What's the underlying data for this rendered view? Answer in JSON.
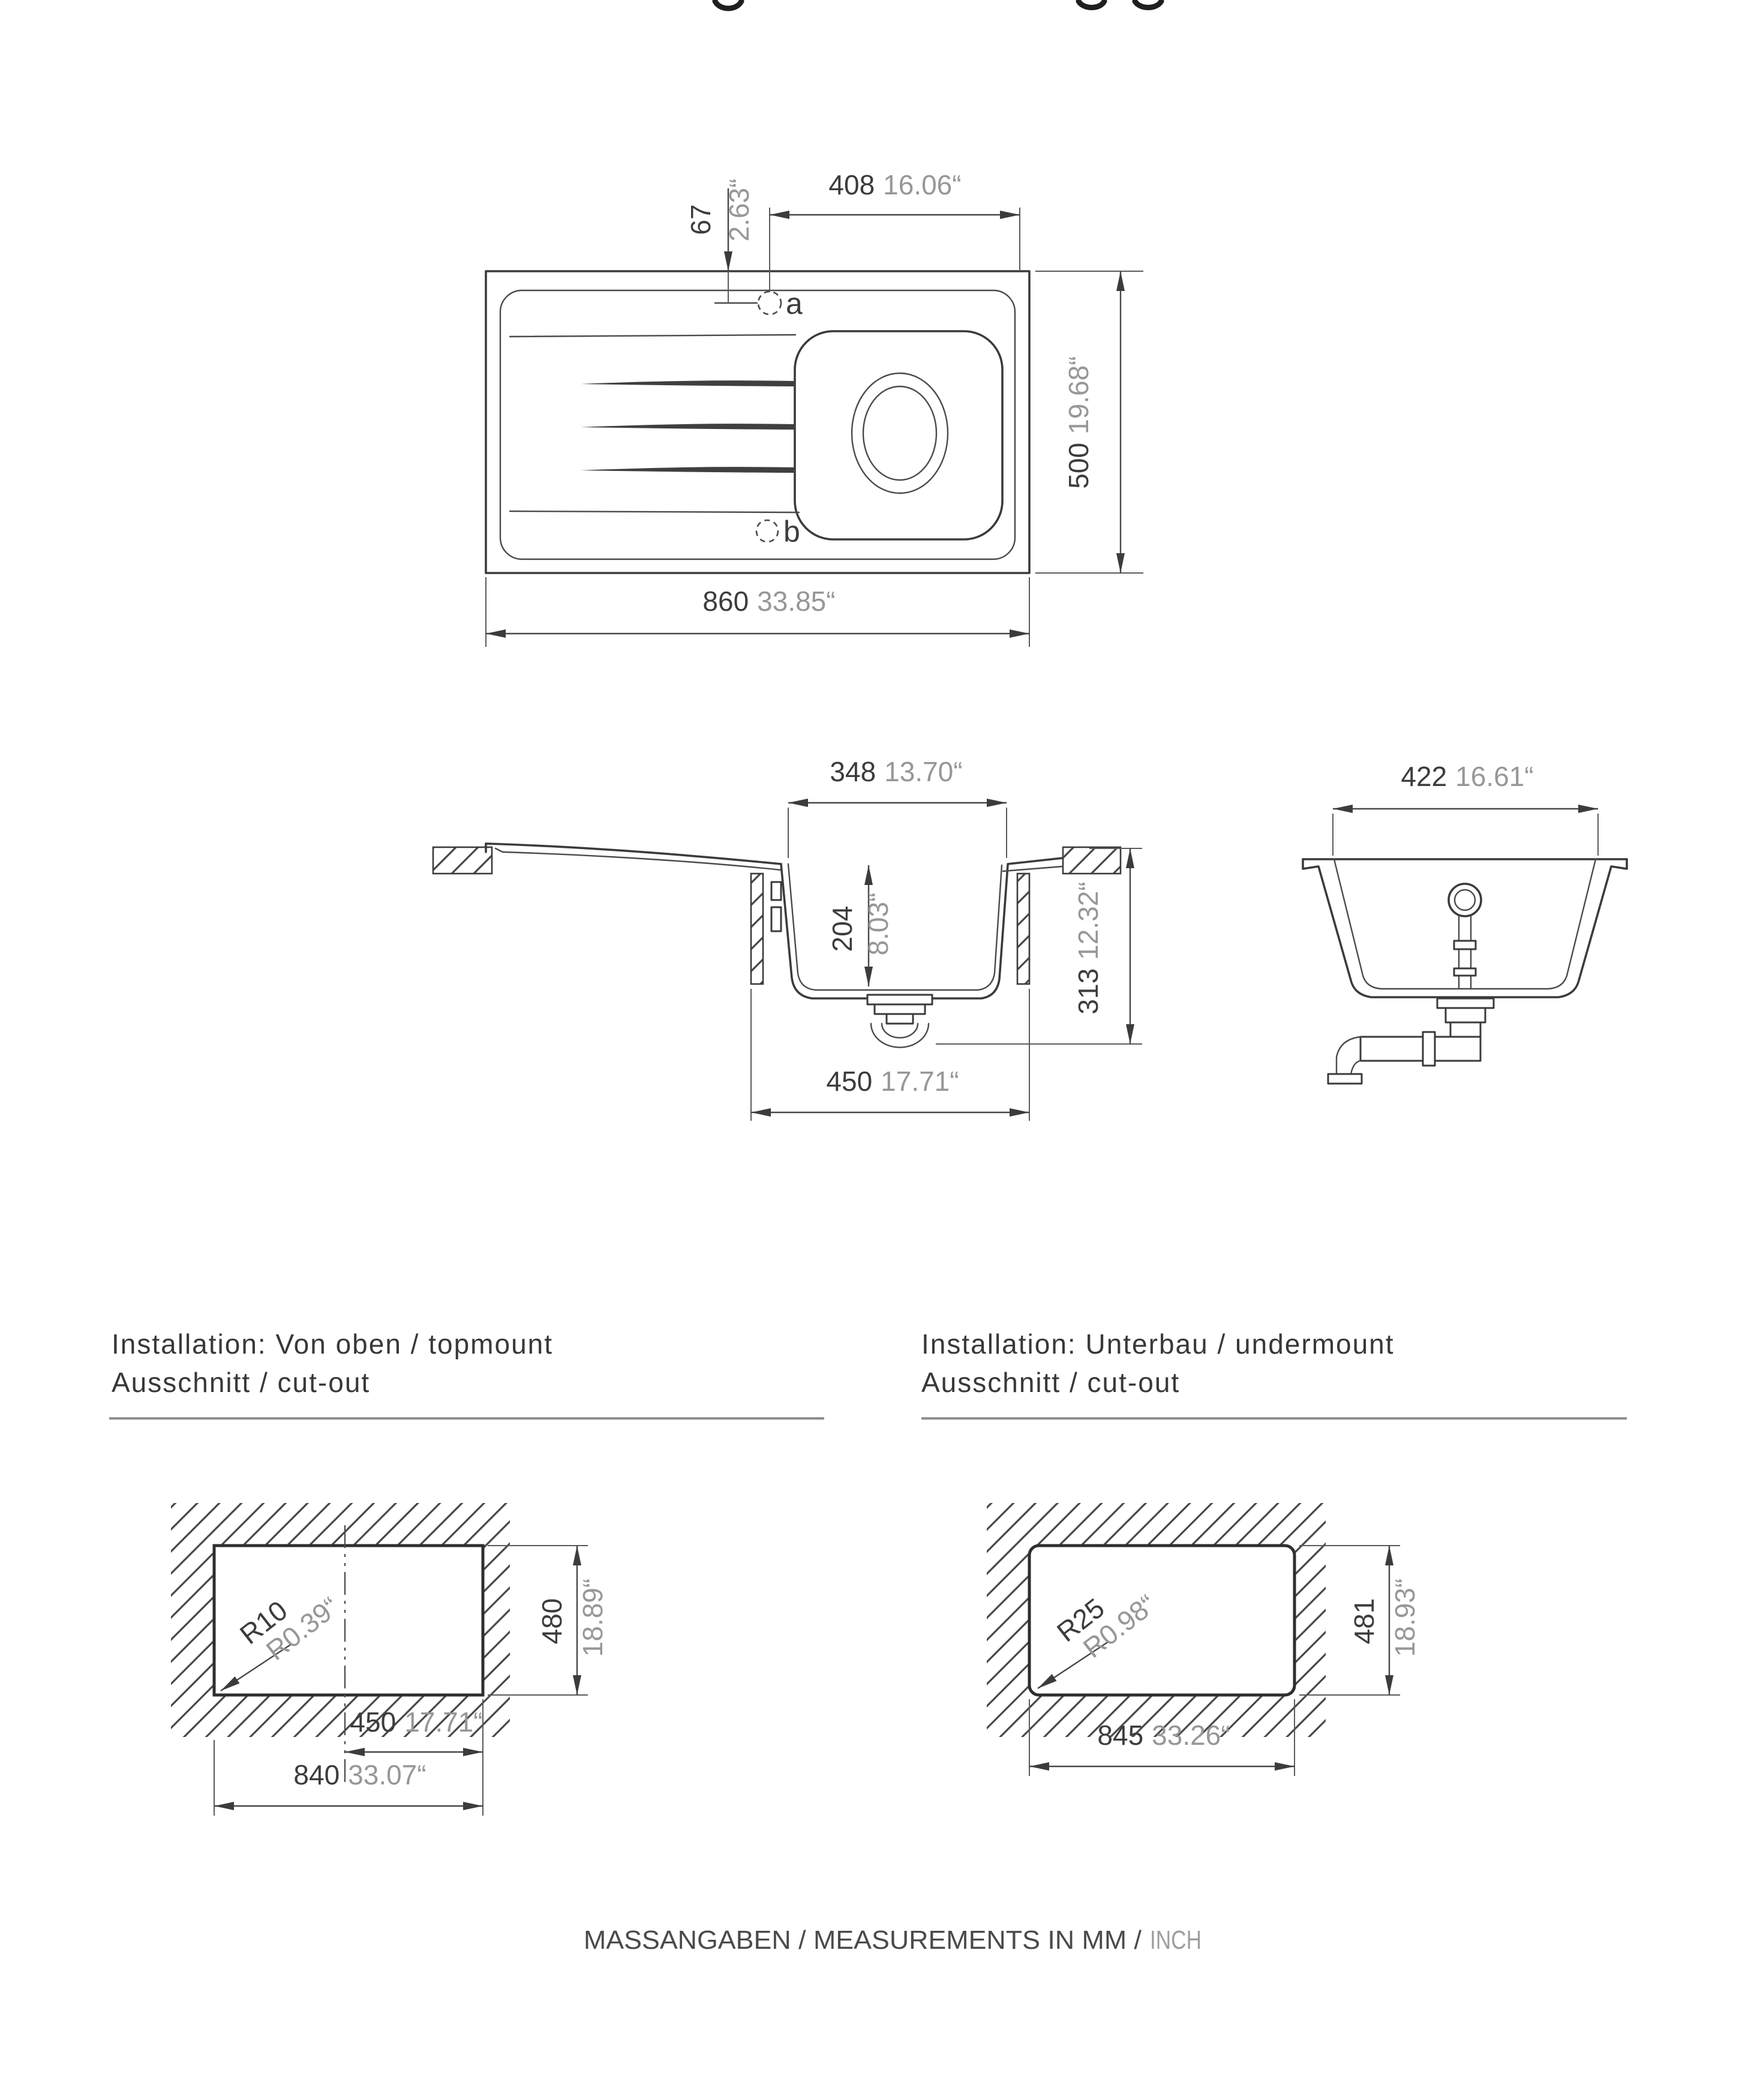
{
  "colors": {
    "background": "#ffffff",
    "drawing_line": "#3b3b3b",
    "dimension_mm_text": "#3c3c3c",
    "dimension_inch_text": "#979797",
    "section_rule": "#8f8f8f",
    "footer_text": "#4a4a4a",
    "footer_inch_text": "#9e9e9e"
  },
  "top_view": {
    "tap_hole_offset_x": {
      "mm": "408",
      "inch": "16.06“"
    },
    "tap_hole_offset_y": {
      "mm": "67",
      "inch": "2.63“"
    },
    "overall_width": {
      "mm": "860",
      "inch": "33.85“"
    },
    "overall_depth": {
      "mm": "500",
      "inch": "19.68“"
    },
    "hole_a_label": "a",
    "hole_b_label": "b"
  },
  "side_section": {
    "bowl_top_width": {
      "mm": "348",
      "inch": "13.70“"
    },
    "bowl_depth": {
      "mm": "204",
      "inch": "8.03“"
    },
    "overall_height": {
      "mm": "313",
      "inch": "12.32“"
    },
    "cabinet_opening": {
      "mm": "450",
      "inch": "17.71“"
    }
  },
  "front_section": {
    "bowl_top_width": {
      "mm": "422",
      "inch": "16.61“"
    }
  },
  "installation_topmount": {
    "line1": "Installation: Von oben / topmount",
    "line2": "Ausschnitt / cut-out"
  },
  "installation_undermount": {
    "line1": "Installation: Unterbau / undermount",
    "line2": "Ausschnitt / cut-out"
  },
  "cutout_topmount": {
    "corner_radius": {
      "mm": "R10",
      "inch": "R0.39“"
    },
    "depth": {
      "mm": "480",
      "inch": "18.89“"
    },
    "center_to_edge": {
      "mm": "450",
      "inch": "17.71“"
    },
    "width": {
      "mm": "840",
      "inch": "33.07“"
    }
  },
  "cutout_undermount": {
    "corner_radius": {
      "mm": "R25",
      "inch": "R0.98“"
    },
    "depth": {
      "mm": "481",
      "inch": "18.93“"
    },
    "width": {
      "mm": "845",
      "inch": "33.26“"
    }
  },
  "footer": {
    "measurements": "MASSANGABEN / MEASUREMENTS IN MM /",
    "inch_word": "INCH"
  }
}
